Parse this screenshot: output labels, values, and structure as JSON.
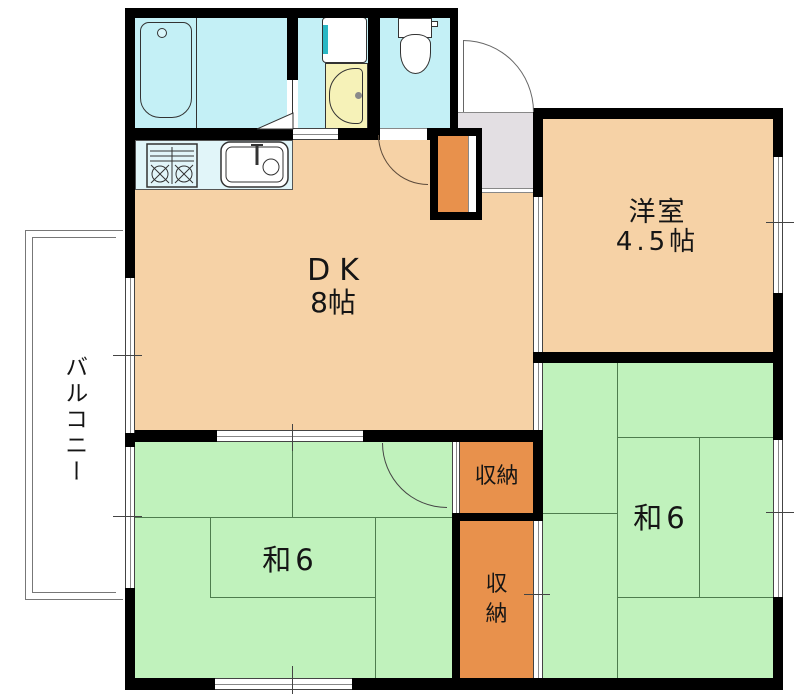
{
  "plan": {
    "rooms": {
      "dk": {
        "label": "DK",
        "size": "8帖"
      },
      "western": {
        "label": "洋室",
        "size": "4.5帖"
      },
      "tatami_left": {
        "label": "和6"
      },
      "tatami_right": {
        "label": "和6"
      },
      "closet_upper": {
        "label": "収納"
      },
      "closet_lower": {
        "label": "収納"
      },
      "balcony": {
        "label": "バルコニー"
      }
    },
    "fixtures": {
      "bathtub": "bathtub-icon",
      "washing_machine": "washing-machine-icon",
      "vanity_basin": "vanity-basin-icon",
      "toilet": "toilet-icon",
      "gas_stove": "gas-stove-icon",
      "kitchen_sink": "kitchen-sink-icon",
      "shoe_cabinet": "shoe-cabinet-icon"
    },
    "colors": {
      "wet_area": "#c4f0f6",
      "counter": "#e1f5f9",
      "flooring": "#f6d2a6",
      "tatami": "#c0f2bc",
      "closet": "#e8914c",
      "entry": "#e3dfe3",
      "vanity": "#f6f2b8",
      "washer_accent": "#2ab7c4",
      "wall": "#000000"
    }
  }
}
